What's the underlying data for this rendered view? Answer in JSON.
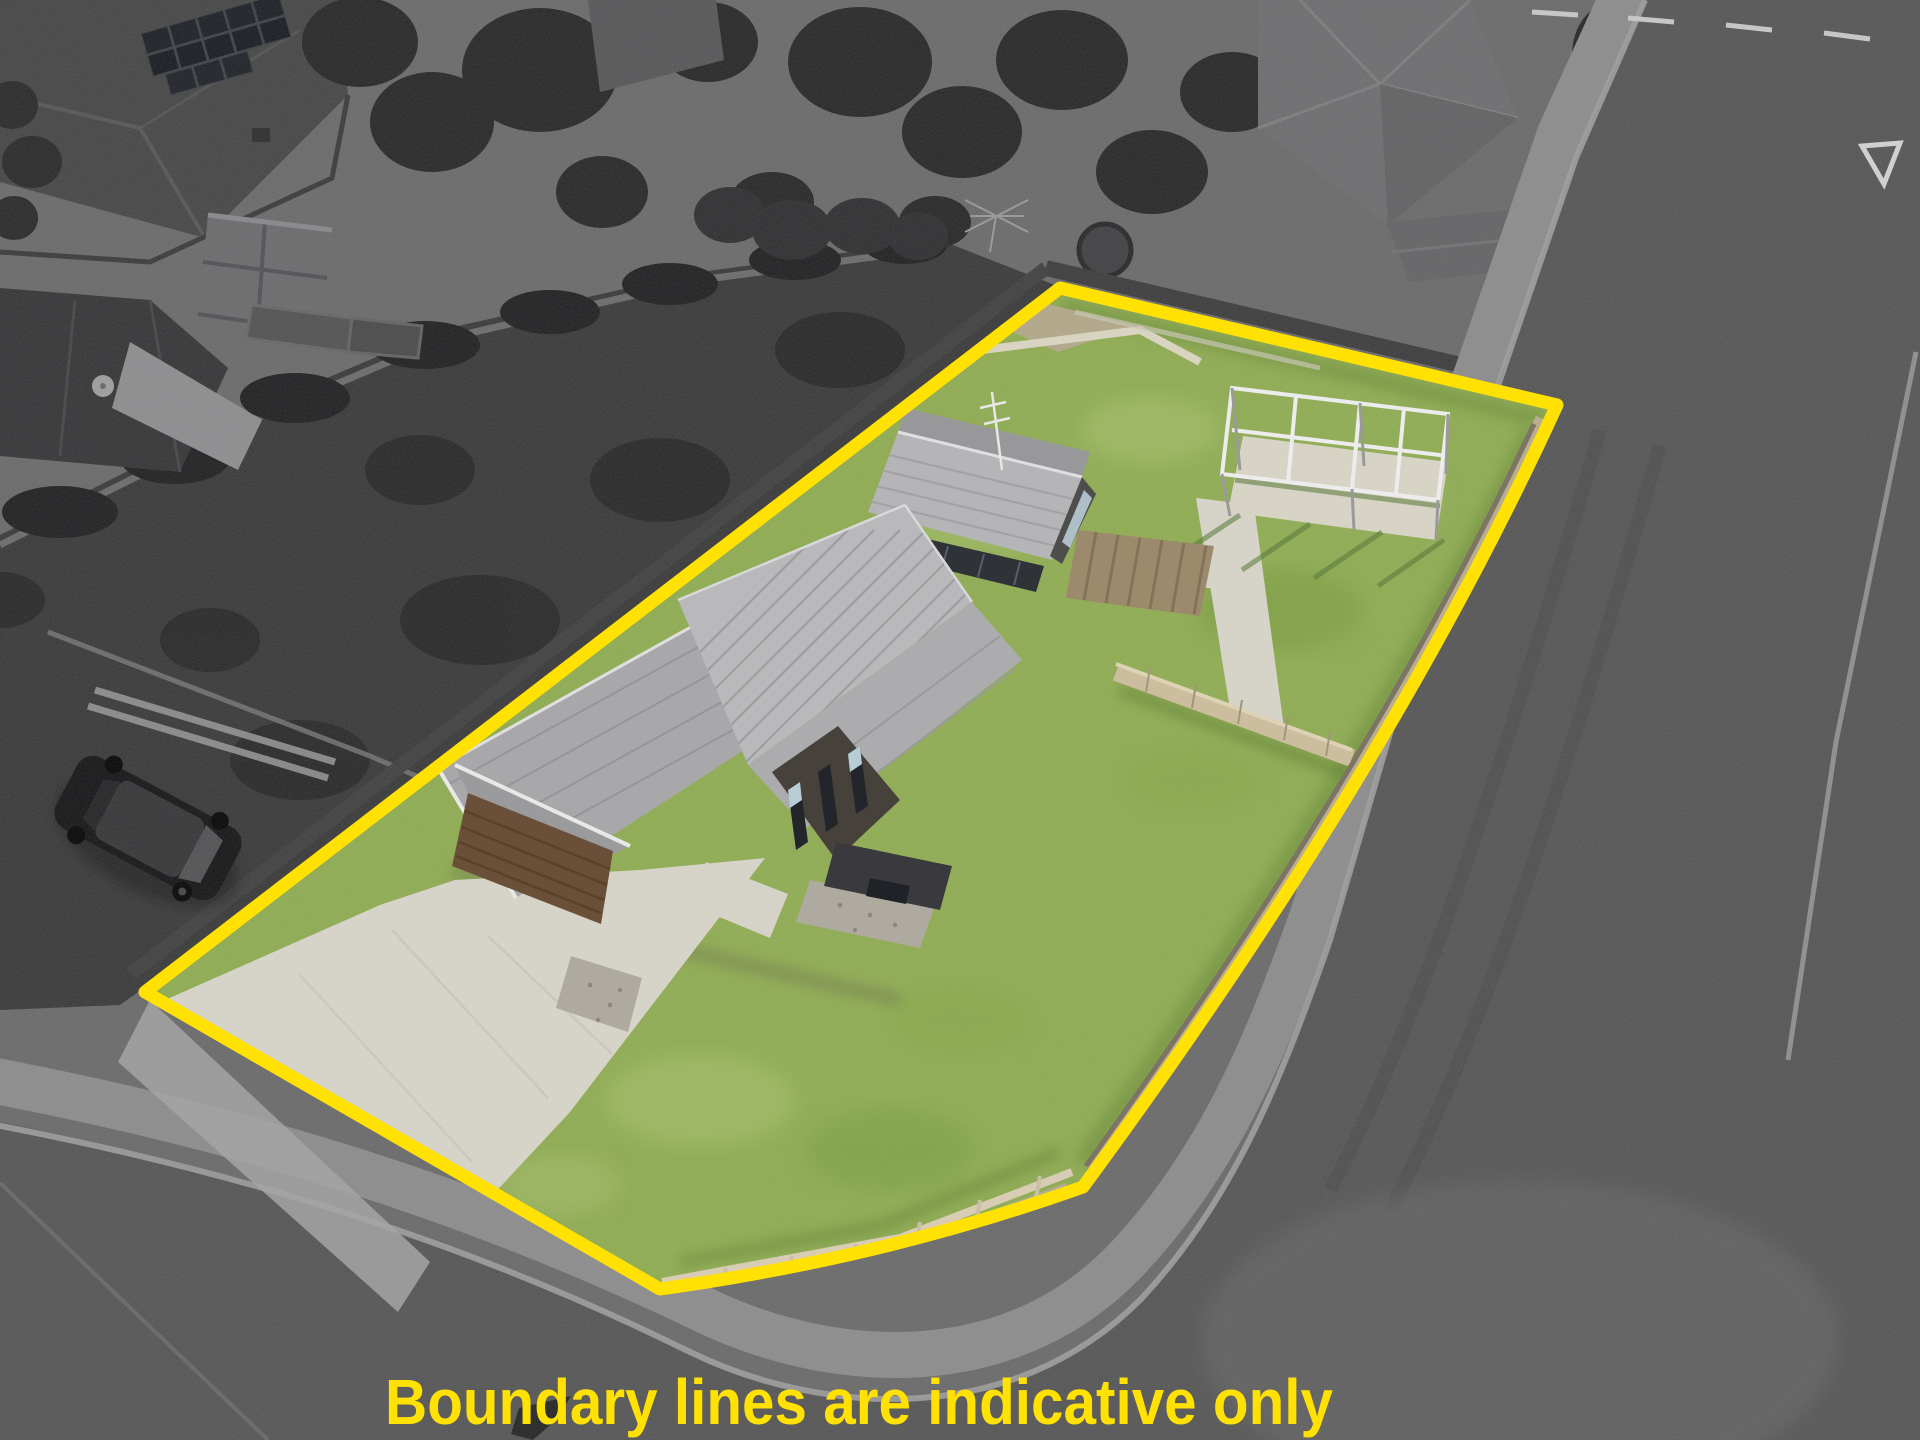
{
  "image": {
    "kind": "aerial-drone-real-estate-photo",
    "width": 1920,
    "height": 1440,
    "treatment": "surroundings desaturated to greyscale; subject property shown in colour inside highlighted boundary"
  },
  "caption": {
    "text": "Boundary lines are indicative only",
    "color": "#FFE103"
  },
  "boundary": {
    "color": "#FFE103",
    "stroke_width": "13",
    "path": "M1060,288 L1557,405 Q1390,770 1083,1187 Q884,1258 660,1289 L145,992 Z"
  },
  "palette": {
    "lawn": "#92AD58",
    "lawn_light": "#A9C273",
    "lawn_dark": "#7C9C45",
    "road": "#595959",
    "footpath": "#8E8E8E",
    "kerb": "#9F9F9F",
    "roof": "#AFAFB1",
    "concrete": "#D6D3C9",
    "gravel": "#AFAAA0",
    "garage_door": "#6A5038",
    "deck_timber": "#9B8A6C",
    "timber_fence": "#B9AD92",
    "dark_vegetation": "#3E3E3E",
    "background_grey": "#6D6D6D",
    "road_marking": "#CFCFCF"
  },
  "scene": {
    "subject": "single-level house with grey metal roof, double garage with brown door, concrete driveway, front and back lawns, pergola frame on concrete pad, timber fences",
    "overlay": "yellow surveyed boundary outline around the lot",
    "surroundings": [
      "neighbouring house with solar panels",
      "garden shed and raised beds",
      "house with satellite dish",
      "overgrown fenced yard",
      "mature trees",
      "hip-roof house by road",
      "kerbed roads with give-way markings and footpaths",
      "parked dark SUV"
    ]
  }
}
